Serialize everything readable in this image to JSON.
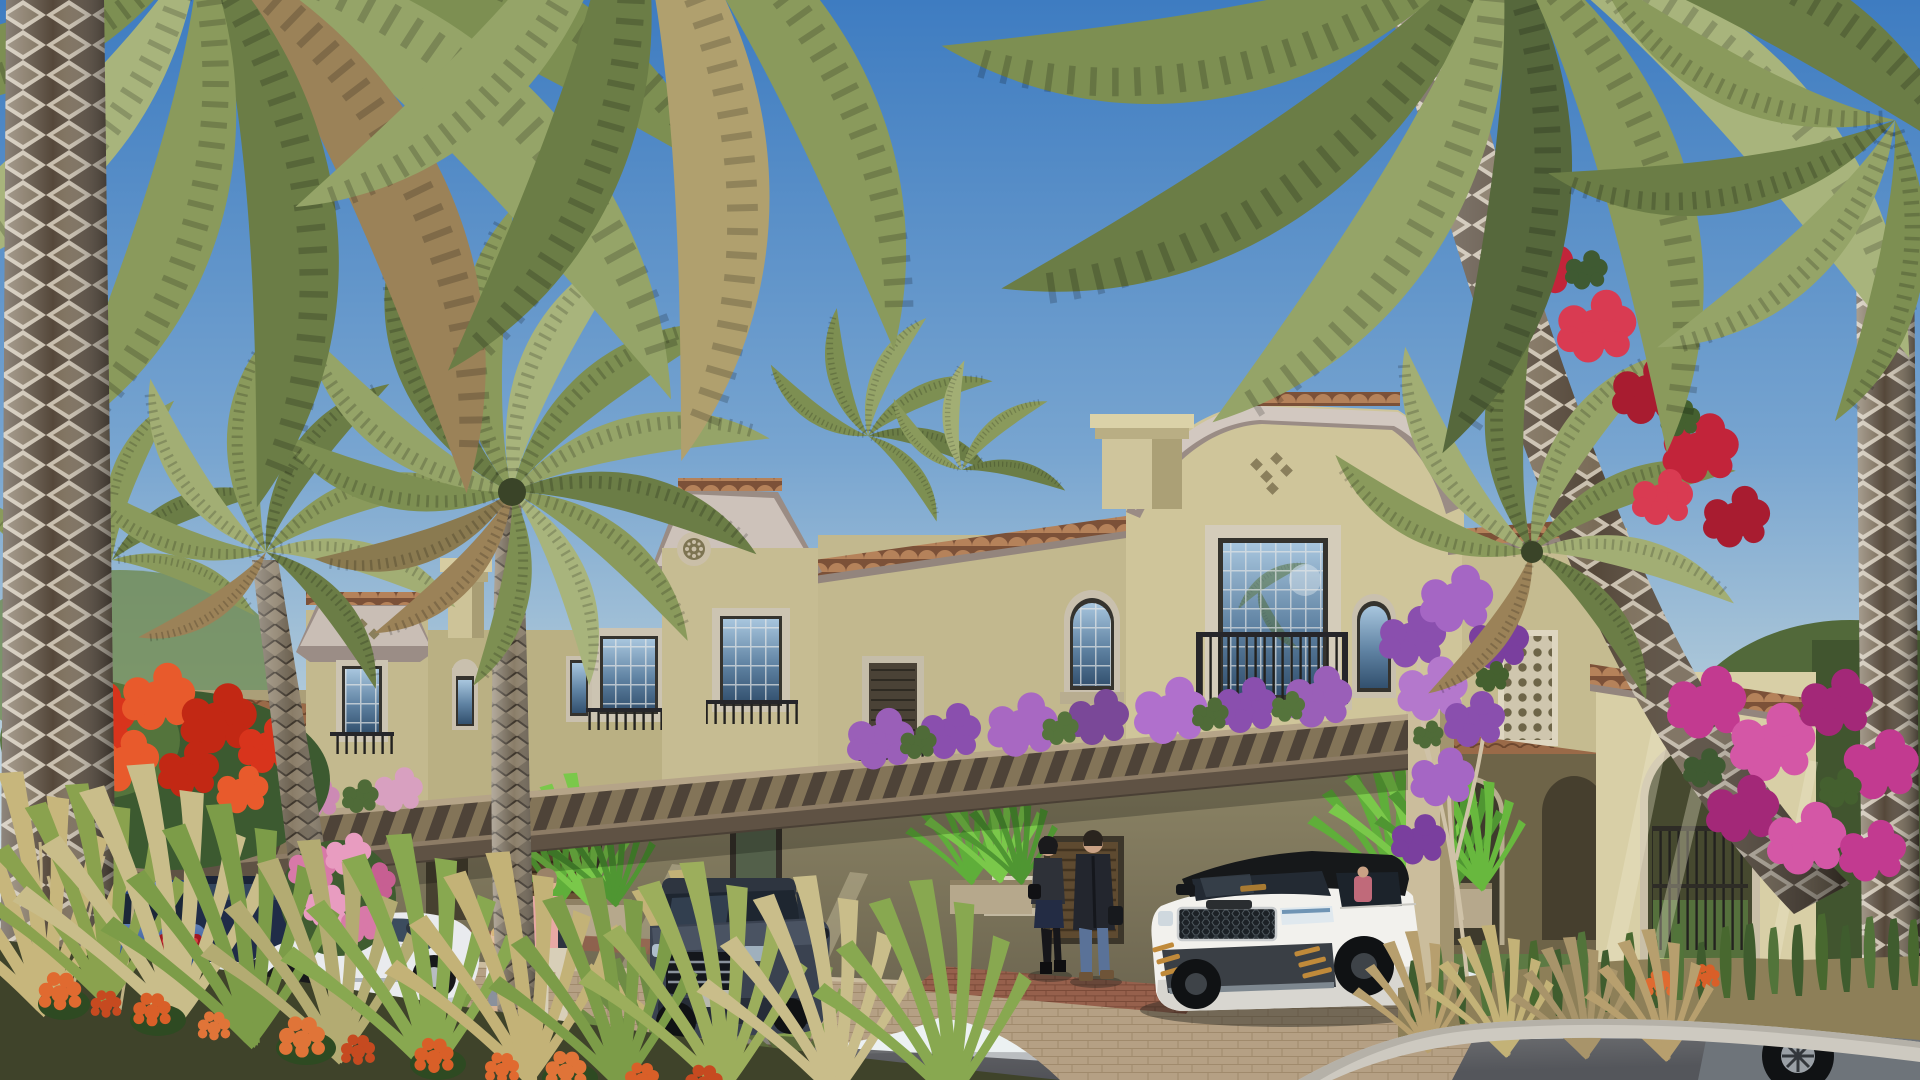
{
  "meta": {
    "title": "Mediterranean townhouse community rendering",
    "alt": "Sunny architectural rendering of a two-storey Mediterranean style townhouse row with beige stucco walls, terracotta roof caps, arched windows, iron juliet balconies and a wooden pergola draped with bougainvillea; date palms frame the scene; luxury cars are parked on the driveway and road; residents walk toward the entrances",
    "setting": "clear blue sky, daytime",
    "style": "photoreal 3D exterior visualization"
  },
  "palette": {
    "sky_top": "#3e7cc1",
    "sky_horizon": "#ecf1f2",
    "stucco_sunlit": "#d6cda4",
    "stucco_mid": "#c6bc92",
    "stucco_shade": "#8f8767",
    "roof_tile": "#a06a48",
    "cornice": "#9a8c85",
    "pergola_wood": "#5f5244",
    "window_glass": "#6f94b4",
    "iron_railing": "#26262a",
    "road_asphalt": "#606267",
    "paver": "#bfa98d",
    "palm_green": "#8a9a5c",
    "bougainvillea_purple": "#9a5fb8",
    "bougainvillea_magenta": "#c23a90",
    "bougainvillea_red": "#c2243a",
    "flame_tree_red": "#d8341c",
    "ixora_orange": "#e06a30"
  },
  "scene": {
    "building": {
      "label": "two-storey Mediterranean townhouse row",
      "features": [
        "gabled parapets with terracotta tile caps",
        "chimneys",
        "diamond wall vents",
        "round rosette medallion",
        "arched and rectangular mullioned windows",
        "iron juliet balconies",
        "wood pergola with climbing flowers",
        "lattice screen panel",
        "arched side gate with iron bars",
        "planter boxes with green shrubs"
      ]
    },
    "vehicles": [
      {
        "label": "blue SUV parked rear view",
        "color": "#2c4f92"
      },
      {
        "label": "dark navy SUV",
        "color": "#202c48"
      },
      {
        "label": "white sports coupe",
        "color": "#e9ebee"
      },
      {
        "label": "grey SUV front view",
        "color": "#3a4250"
      },
      {
        "label": "white luxury SUV with black roof and mesh grille",
        "color": "#f2f1ed"
      },
      {
        "label": "grey sports car entering frame bottom right",
        "color": "#6e747a"
      }
    ],
    "people": [
      {
        "label": "child in white t-shirt"
      },
      {
        "label": "man in pink shirt and khaki trousers"
      },
      {
        "label": "woman in dark jacket and skirt"
      },
      {
        "label": "man in long dark coat with bag"
      }
    ],
    "vegetation": [
      {
        "label": "date palms with patterned trunks"
      },
      {
        "label": "red flame-tree blossom"
      },
      {
        "label": "purple bougainvillea on pergola"
      },
      {
        "label": "crimson and magenta bougainvillea on right palms"
      },
      {
        "label": "pink rose bush"
      },
      {
        "label": "orange ixora and ornamental grasses in foreground"
      },
      {
        "label": "sansevieria bed behind right kerb"
      }
    ],
    "ground": [
      {
        "label": "asphalt road"
      },
      {
        "label": "beige paver driveway apron"
      },
      {
        "label": "red paver walkway"
      },
      {
        "label": "kerbed planting islands"
      }
    ]
  }
}
